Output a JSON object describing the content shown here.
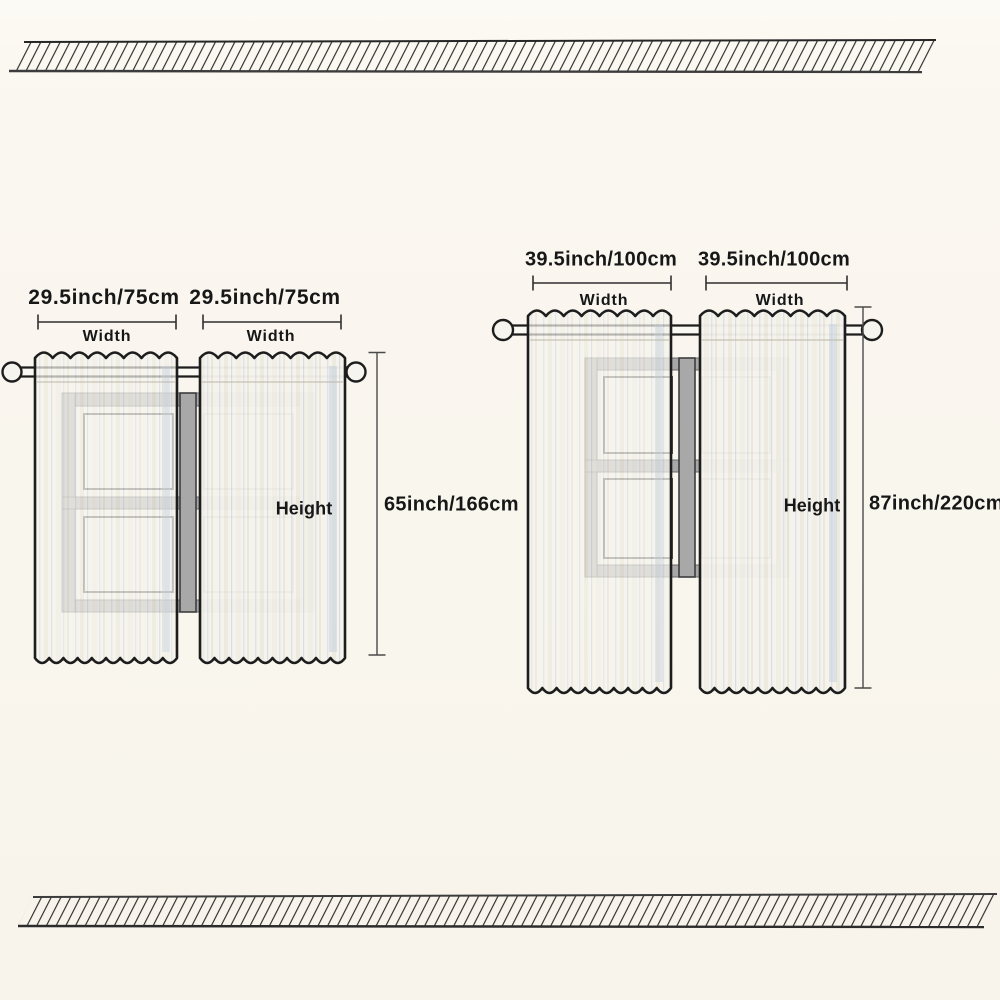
{
  "image_type": "curtain-size-dimension-diagram",
  "palette": {
    "background": "#f9f6ee",
    "outline": "#1d1d1d",
    "hatch_line": "#2d2d2d",
    "window_frame": "#a8a8a8",
    "dimension_line": "#3b3b3b",
    "curtain_base": "#f4f2ea",
    "curtain_stripe": "#d8dde3",
    "text": "#171717"
  },
  "diagrams": {
    "small": {
      "panels": [
        {
          "width_value": "29.5inch/75cm",
          "width_caption": "Width"
        },
        {
          "width_value": "29.5inch/75cm",
          "width_caption": "Width"
        }
      ],
      "height_caption": "Height",
      "height_value": "65inch/166cm"
    },
    "large": {
      "panels": [
        {
          "width_value": "39.5inch/100cm",
          "width_caption": "Width"
        },
        {
          "width_value": "39.5inch/100cm",
          "width_caption": "Width"
        }
      ],
      "height_caption": "Height",
      "height_value": "87inch/220cm"
    }
  }
}
